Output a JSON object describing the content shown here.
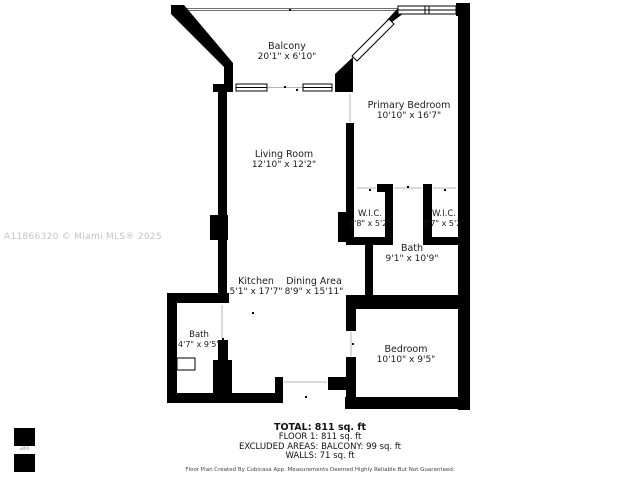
{
  "watermark": "A11866320 © Miami MLS® 2025",
  "rooms": [
    {
      "id": "balcony",
      "name": "Balcony",
      "dims": "20'1\" x 6'10\""
    },
    {
      "id": "primary-bedroom",
      "name": "Primary Bedroom",
      "dims": "10'10\" x 16'7\""
    },
    {
      "id": "living-room",
      "name": "Living Room",
      "dims": "12'10\" x 12'2\""
    },
    {
      "id": "wic-left",
      "name": "W.I.C.",
      "dims": "3'8\" x 5'2\""
    },
    {
      "id": "wic-right",
      "name": "W.I.C.",
      "dims": "3'7\" x 5'2\""
    },
    {
      "id": "bath-main",
      "name": "Bath",
      "dims": "9'1\" x 10'9\""
    },
    {
      "id": "kitchen",
      "name": "Kitchen",
      "dims": "5'1\" x 17'7\""
    },
    {
      "id": "dining-area",
      "name": "Dining Area",
      "dims": "8'9\" x 15'11\""
    },
    {
      "id": "bath-small",
      "name": "Bath",
      "dims": "4'7\" x 9'5\""
    },
    {
      "id": "bedroom",
      "name": "Bedroom",
      "dims": "10'10\" x 9'5\""
    }
  ],
  "summary": {
    "total": "TOTAL: 811 sq. ft",
    "floor": "FLOOR 1: 811 sq. ft",
    "excluded": "EXCLUDED AREAS: BALCONY: 99 sq. ft",
    "walls": "WALLS: 71 sq. ft"
  },
  "disclaimer": "Floor Plan Created By Cubicasa App. Measurements Deemed Highly Reliable But Not Guaranteed.",
  "logo": {
    "text": "⌂PIX"
  },
  "colors": {
    "wall": "#000000",
    "watermark": "#c4c4c4",
    "background": "#ffffff"
  }
}
